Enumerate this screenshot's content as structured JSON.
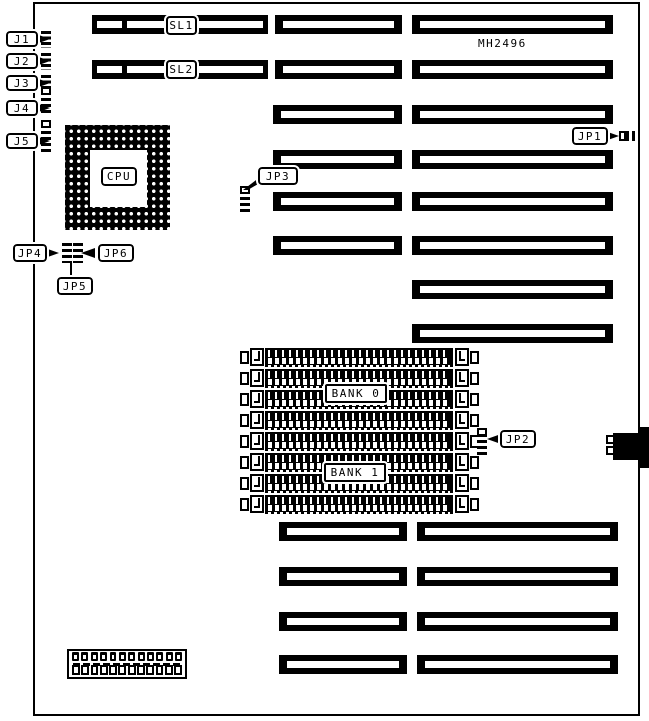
{
  "diagram": {
    "part_number": "MH2496",
    "cpu_label": "CPU",
    "cache_slots": {
      "sl1": "SL1",
      "sl2": "SL2"
    },
    "memory_banks": {
      "bank0": "BANK 0",
      "bank1": "BANK 1"
    },
    "connectors": {
      "j1": "J1",
      "j2": "J2",
      "j3": "J3",
      "j4": "J4",
      "j5": "J5"
    },
    "jumpers": {
      "jp1": "JP1",
      "jp2": "JP2",
      "jp3": "JP3",
      "jp4": "JP4",
      "jp5": "JP5",
      "jp6": "JP6"
    },
    "colors": {
      "ink": "#000000",
      "paper": "#ffffff"
    },
    "power_connector": {
      "pin_count": 12,
      "pad_count": 12
    },
    "simm_slot_count": 8
  }
}
